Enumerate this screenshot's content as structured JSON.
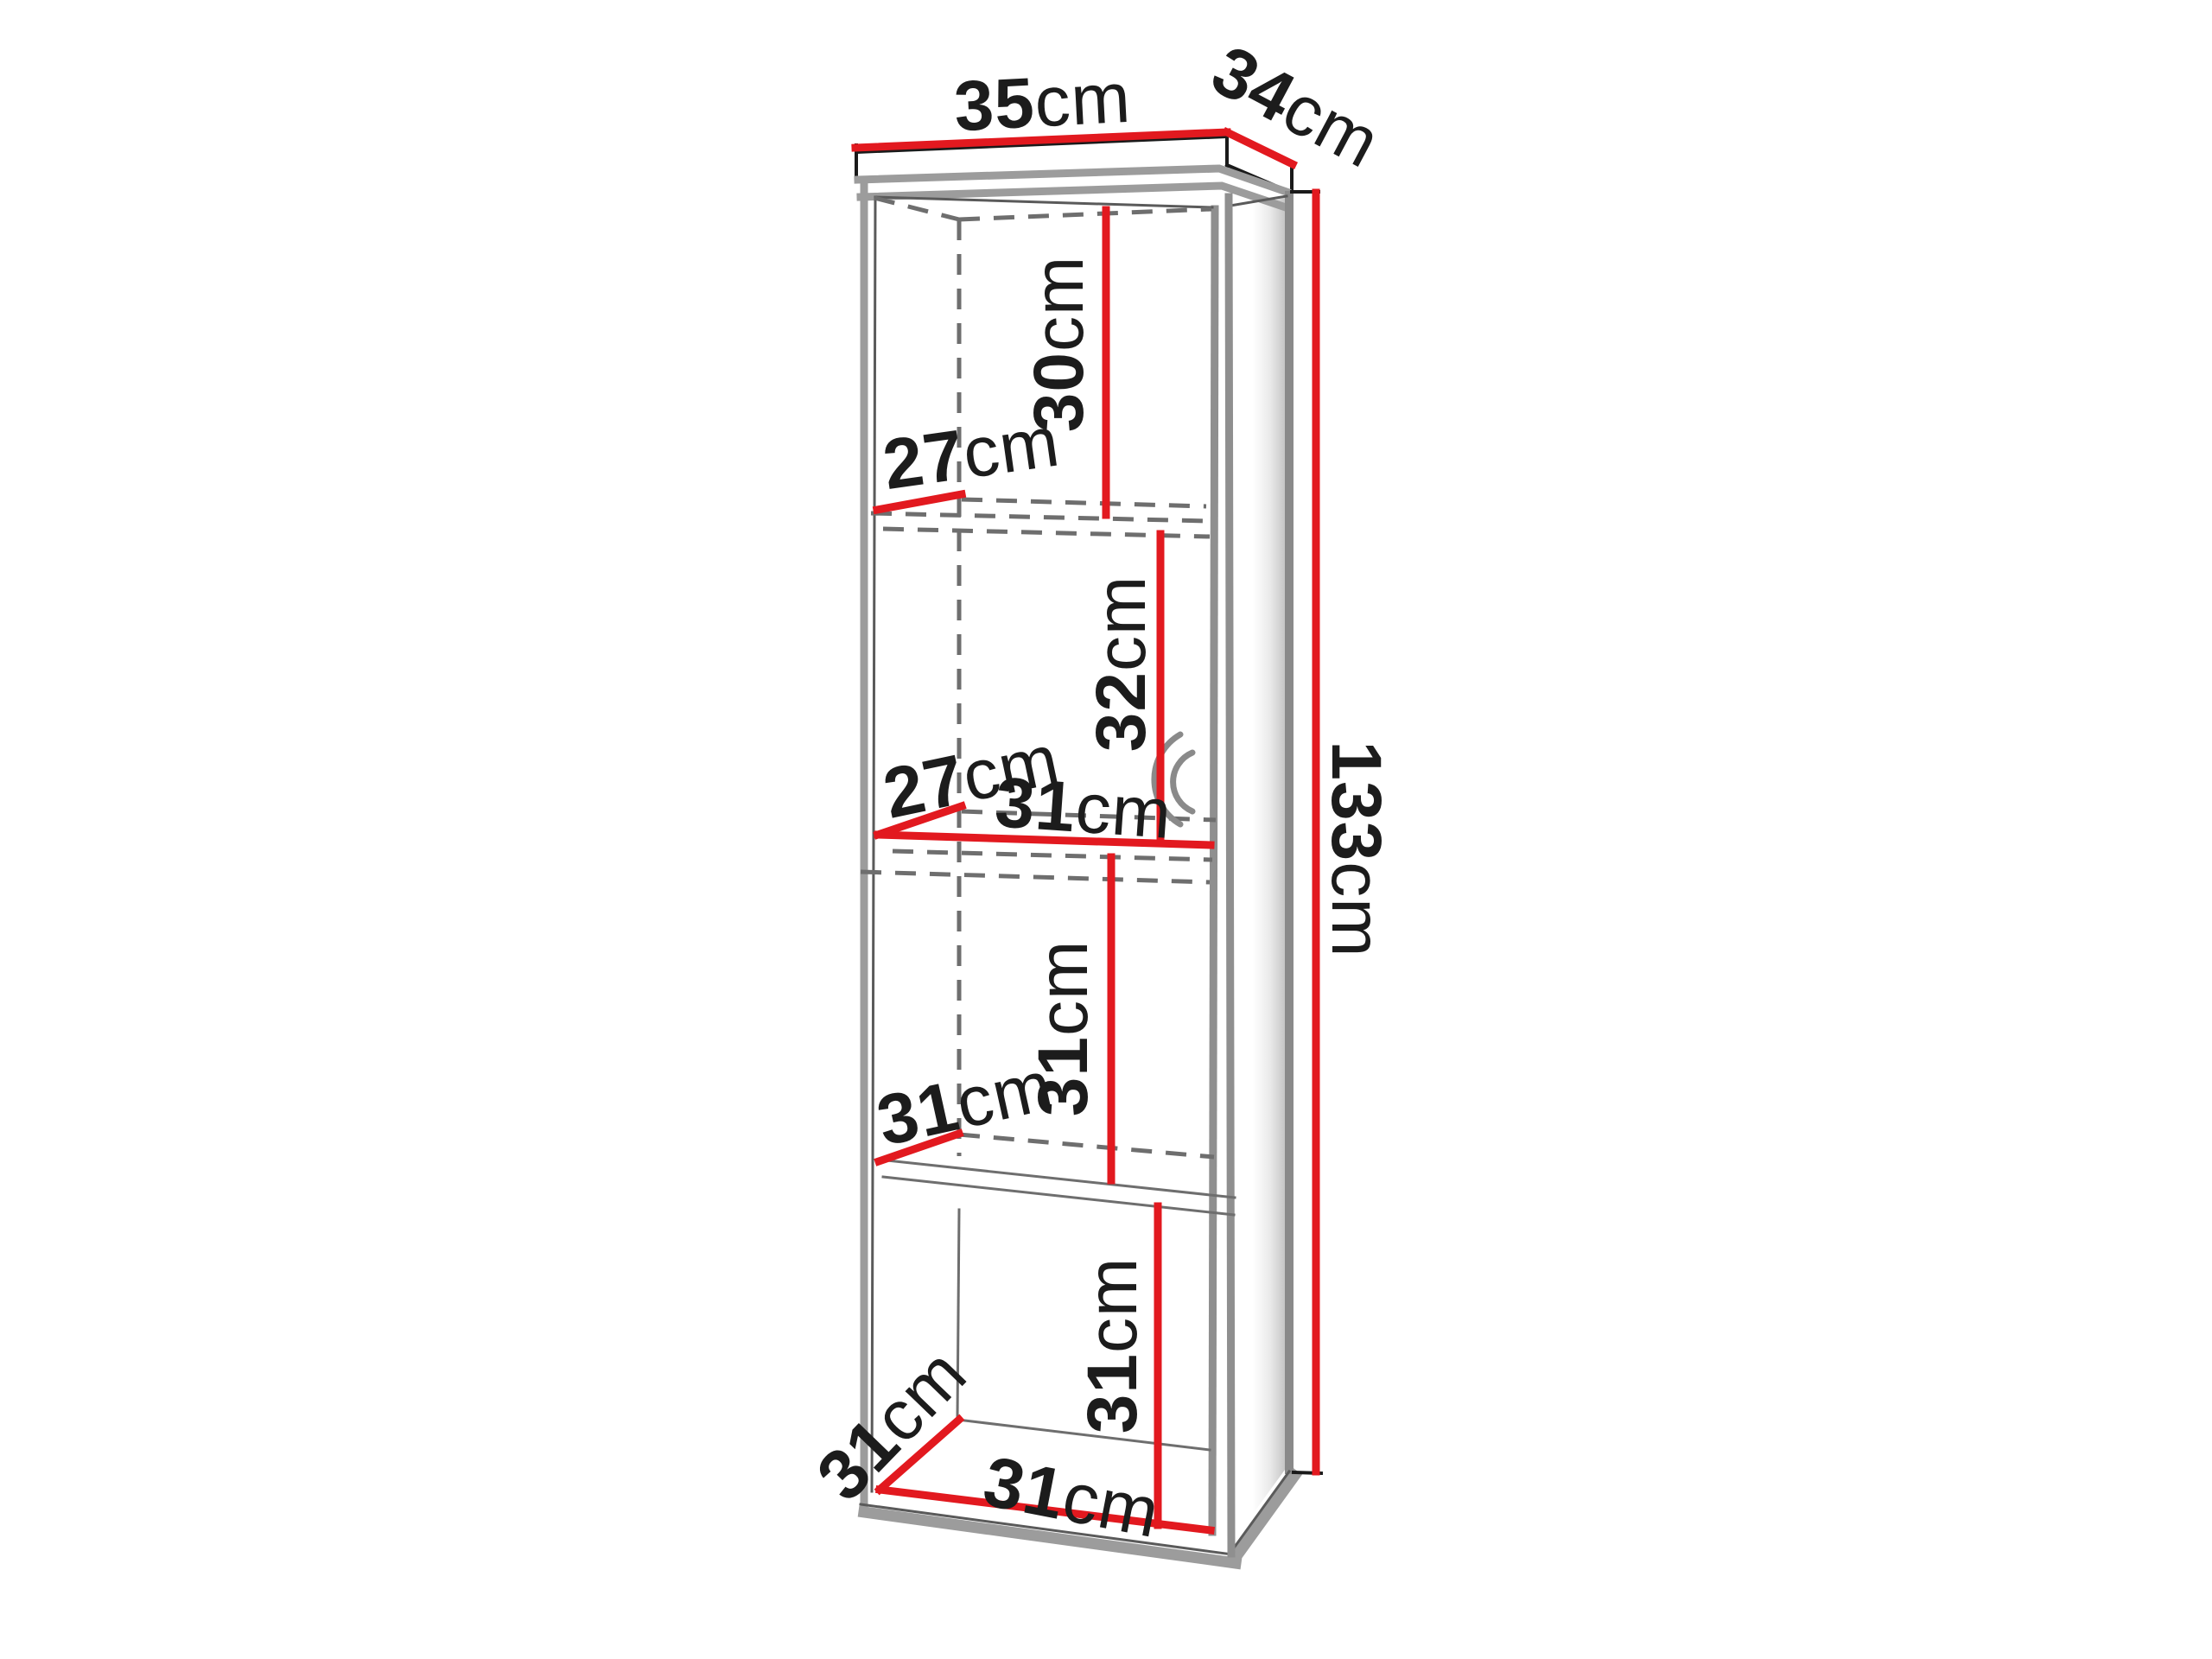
{
  "figure": {
    "kind": "furniture-dimension-diagram",
    "subject": "tall open shelf cabinet with four compartments, drawn in perspective with red dimension lines",
    "background_color": "#ffffff",
    "accent_red": "#e2191f",
    "line_gray": "#9c9c9c",
    "text_color": "#1c1c1c"
  },
  "dims": {
    "top_width": {
      "value": "35",
      "unit": "cm"
    },
    "top_depth": {
      "value": "34",
      "unit": "cm"
    },
    "total_height": {
      "value": "133",
      "unit": "cm"
    },
    "comp1_height": {
      "value": "30",
      "unit": "cm"
    },
    "comp1_depth": {
      "value": "27",
      "unit": "cm"
    },
    "comp2_height": {
      "value": "32",
      "unit": "cm"
    },
    "comp2_depth": {
      "value": "27",
      "unit": "cm"
    },
    "comp2_width": {
      "value": "31",
      "unit": "cm"
    },
    "comp3_height": {
      "value": "31",
      "unit": "cm"
    },
    "comp3_depth": {
      "value": "31",
      "unit": "cm"
    },
    "comp4_height": {
      "value": "31",
      "unit": "cm"
    },
    "bottom_depth": {
      "value": "31",
      "unit": "cm"
    },
    "bottom_width": {
      "value": "31",
      "unit": "cm"
    }
  }
}
